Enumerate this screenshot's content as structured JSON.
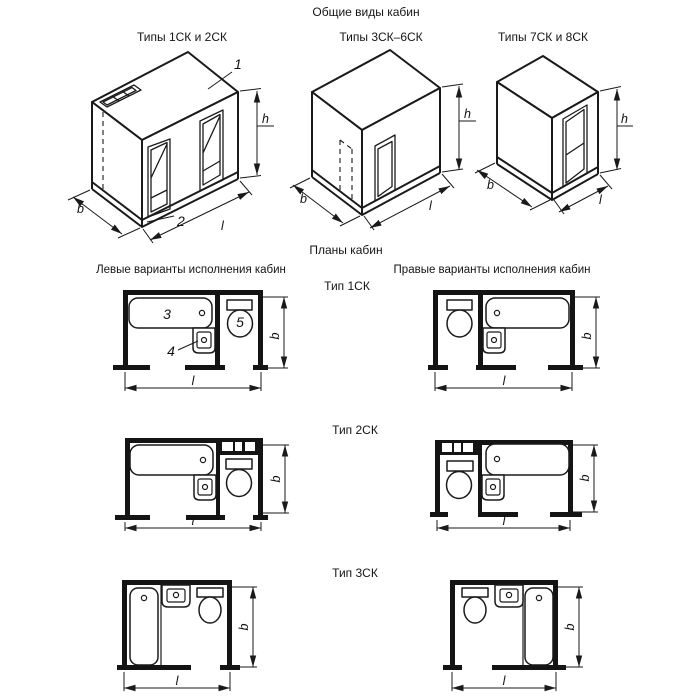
{
  "titles": {
    "main": "Общие виды кабин",
    "plans": "Планы кабин",
    "left_variants": "Левые варианты исполнения кабин",
    "right_variants": "Правые варианты исполнения кабин"
  },
  "views": {
    "v1": "Типы 1СК и 2СК",
    "v2": "Типы 3СК–6СК",
    "v3": "Типы 7СК и 8СК"
  },
  "rows": {
    "r1": "Тип 1СК",
    "r2": "Тип 2СК",
    "r3": "Тип 3СК"
  },
  "dim": {
    "b": "b",
    "l": "l",
    "h": "h"
  },
  "callouts": {
    "c1": "1",
    "c2": "2",
    "c3": "3",
    "c4": "4",
    "c5": "5"
  },
  "colors": {
    "line": "#1a1a1a",
    "background": "#ffffff"
  }
}
